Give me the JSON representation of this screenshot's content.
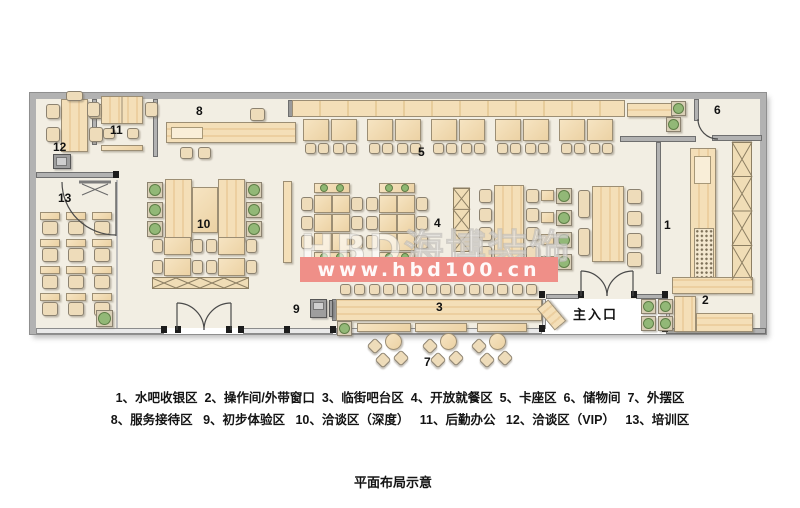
{
  "watermark": {
    "brand": "HBD海博装饰",
    "url": "www.hbd100.cn",
    "band_color": "#ef8f88"
  },
  "entrance_label": "主入口",
  "caption": "平面布局示意",
  "legend": {
    "line1": "1、水吧收银区  2、操作间/外带窗口  3、临街吧台区  4、开放就餐区  5、卡座区  6、储物间  7、外摆区",
    "line2": "8、服务接待区   9、初步体验区   10、洽谈区（深度）   11、后勤办公   12、洽谈区（VIP）   13、培训区"
  },
  "zones": [
    {
      "num": "1",
      "name": "水吧收银区",
      "x": 664,
      "y": 219
    },
    {
      "num": "2",
      "name": "操作间/外带窗口",
      "x": 702,
      "y": 294
    },
    {
      "num": "3",
      "name": "临街吧台区",
      "x": 436,
      "y": 301
    },
    {
      "num": "4",
      "name": "开放就餐区",
      "x": 434,
      "y": 217
    },
    {
      "num": "5",
      "name": "卡座区",
      "x": 418,
      "y": 146
    },
    {
      "num": "6",
      "name": "储物间",
      "x": 714,
      "y": 104
    },
    {
      "num": "7",
      "name": "外摆区",
      "x": 424,
      "y": 356
    },
    {
      "num": "8",
      "name": "服务接待区",
      "x": 196,
      "y": 105
    },
    {
      "num": "9",
      "name": "初步体验区",
      "x": 293,
      "y": 303
    },
    {
      "num": "10",
      "name": "洽谈区（深度）",
      "x": 197,
      "y": 218
    },
    {
      "num": "11",
      "name": "后勤办公",
      "x": 110,
      "y": 124
    },
    {
      "num": "12",
      "name": "洽谈区（VIP）",
      "x": 53,
      "y": 141
    },
    {
      "num": "13",
      "name": "培训区",
      "x": 58,
      "y": 192
    }
  ],
  "colors": {
    "floor": "#f2eee3",
    "wall": "#b2b2b2",
    "wood": "#f0d9ae",
    "plant_green": "#8fb873"
  }
}
